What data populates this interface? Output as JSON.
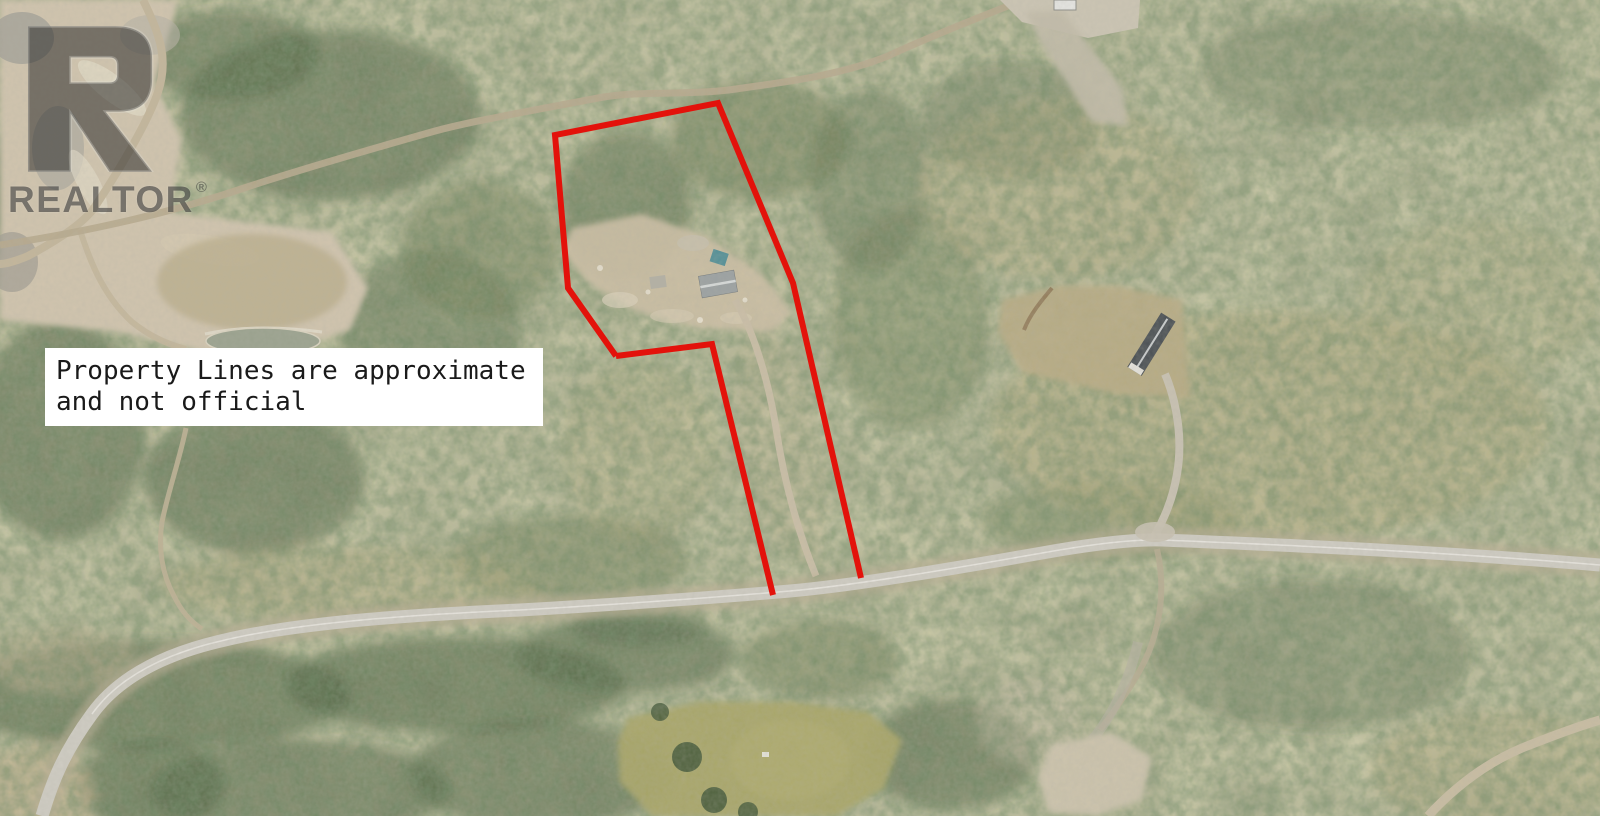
{
  "watermark": {
    "logo_letter": "R",
    "brand": "REALTOR",
    "registered_mark": "®"
  },
  "disclaimer": {
    "line1": "Property Lines are approximate",
    "line2": "and not official"
  },
  "property_line": {
    "outer_points": "616,356 568,288 555,135 718,103 793,283 861,578",
    "inner_points": "616,356 712,344 773,595",
    "stroke_width": "6"
  },
  "colors": {
    "property_line": "#e3120b",
    "disclaimer_bg": "#ffffff",
    "disclaimer_text": "#1a1a1a",
    "watermark_gray": "#262626",
    "paved_road": "#d0cdc4",
    "dirt_road": "#b7a98c",
    "gravel_pit": "#d2c5ae",
    "pond": "#99a18d",
    "forest_dark": "#3f5736",
    "forest_base": "#878560",
    "meadow": "#a8a565",
    "house_roof": "#9aa0a2",
    "outbuilding_roof": "#454b50",
    "teal_object": "#4f8e96"
  }
}
